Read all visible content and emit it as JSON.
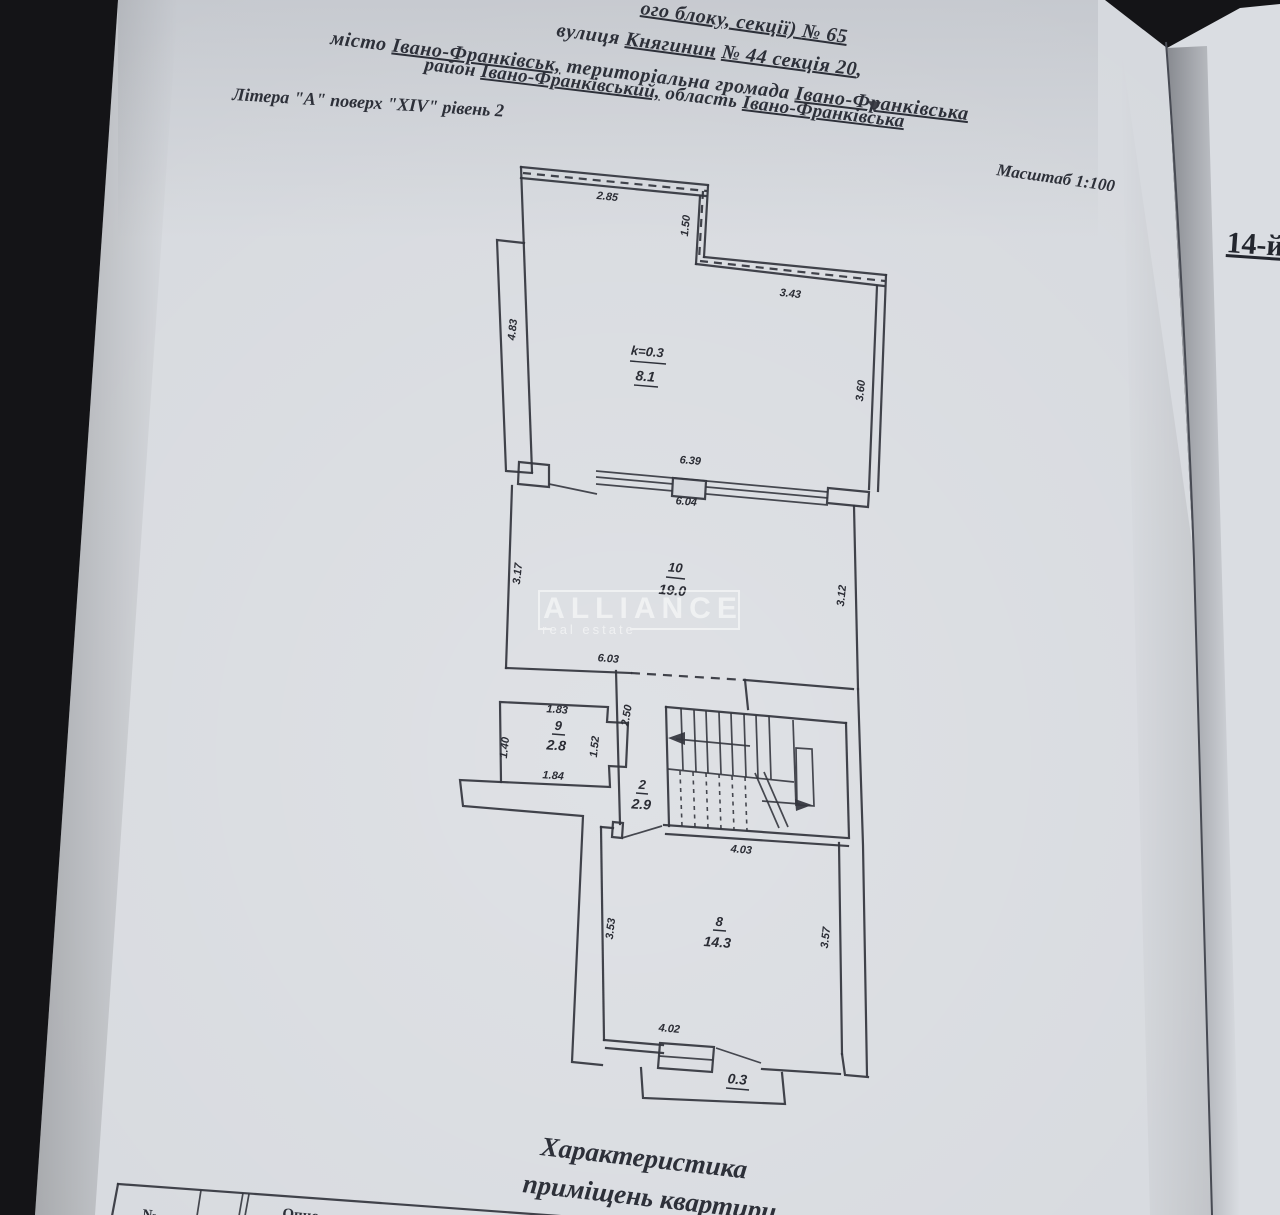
{
  "header": {
    "line1": [
      "ого блоку, секції) ",
      "№ 65"
    ],
    "line2": [
      "вулиця ",
      "Княгинин",
      " ",
      "№ 44 секція 20",
      ","
    ],
    "line3": [
      "місто ",
      "Івано-Франківськ,",
      " територіальна громада ",
      "Івано-Франківська"
    ],
    "line4": [
      "район ",
      "Івано-Франківський,",
      " область ",
      "Івано-Франківська"
    ],
    "line5": "Літера \"А\" поверх \"XIV\" рівень 2",
    "scale": "Масштаб 1:100"
  },
  "right_page": {
    "floor_label": "14-й"
  },
  "watermark": {
    "title": "ALLIANCE",
    "subtitle": "real estate"
  },
  "plan": {
    "rooms": {
      "terrace": {
        "coef": "k=0.3",
        "area": "8.1"
      },
      "room10": {
        "num": "10",
        "area": "19.0"
      },
      "room9": {
        "num": "9",
        "area": "2.8"
      },
      "hall": {
        "num": "2",
        "area": "2.9"
      },
      "room8": {
        "num": "8",
        "area": "14.3"
      },
      "balcony": {
        "area": "0.3"
      }
    },
    "dims": {
      "terrace_top": "2.85",
      "terrace_notch": "1.50",
      "terrace_top_right": "3.43",
      "terrace_left": "4.83",
      "terrace_right": "3.60",
      "window_outer": "6.39",
      "window_inner": "6.04",
      "room10_left": "3.17",
      "room10_right": "3.12",
      "room10_bottom": "6.03",
      "room9_top": "1.83",
      "room9_left": "1.40",
      "room9_right": "1.52",
      "room9_bottom": "1.84",
      "hall_height": "2.50",
      "stairs_bottom": "4.03",
      "room8_left": "3.53",
      "room8_right": "3.57",
      "room8_bottom": "4.02"
    }
  },
  "caption": {
    "line1": "Характеристика",
    "line2": "приміщень квартири"
  },
  "table": {
    "col_no": "№",
    "col_desc": "Опис"
  }
}
